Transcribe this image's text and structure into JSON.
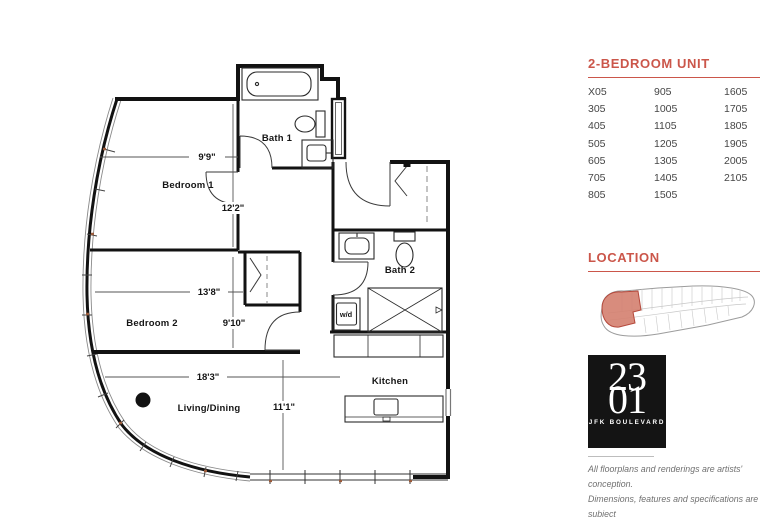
{
  "floorplan": {
    "room_labels": {
      "bath1": "Bath 1",
      "bedroom1": "Bedroom 1",
      "bedroom2": "Bedroom 2",
      "bath2": "Bath 2",
      "kitchen": "Kitchen",
      "living_dining": "Living/Dining",
      "washer_dryer": "w/d"
    },
    "dimensions": {
      "bedroom1_width": "9'9\"",
      "bedroom1_length": "12'2\"",
      "bedroom2_width": "13'8\"",
      "bedroom2_length": "9'10\"",
      "living_width": "18'3\"",
      "living_length": "11'1\""
    }
  },
  "unit_panel": {
    "title": "2-BEDROOM UNIT",
    "columns": [
      [
        "X05",
        "305",
        "405",
        "505",
        "605",
        "705",
        "805"
      ],
      [
        "905",
        "1005",
        "1105",
        "1205",
        "1305",
        "1405",
        "1505"
      ],
      [
        "1605",
        "1705",
        "1805",
        "1905",
        "2005",
        "2105"
      ]
    ]
  },
  "location_panel": {
    "title": "LOCATION"
  },
  "logo": {
    "line1": "23",
    "line2": "01",
    "subtitle": "JFK BOULEVARD"
  },
  "disclaimer": {
    "line1": "All floorplans and renderings are artists' conception.",
    "line2": "Dimensions, features and specifications are subject",
    "line3": "to change at the discretion of the builder."
  },
  "colors": {
    "accent_red": "#cb564a",
    "highlight_fill": "#d4806f",
    "wall_black": "#121212",
    "text_gray": "#707070",
    "logo_bg": "#141414"
  }
}
